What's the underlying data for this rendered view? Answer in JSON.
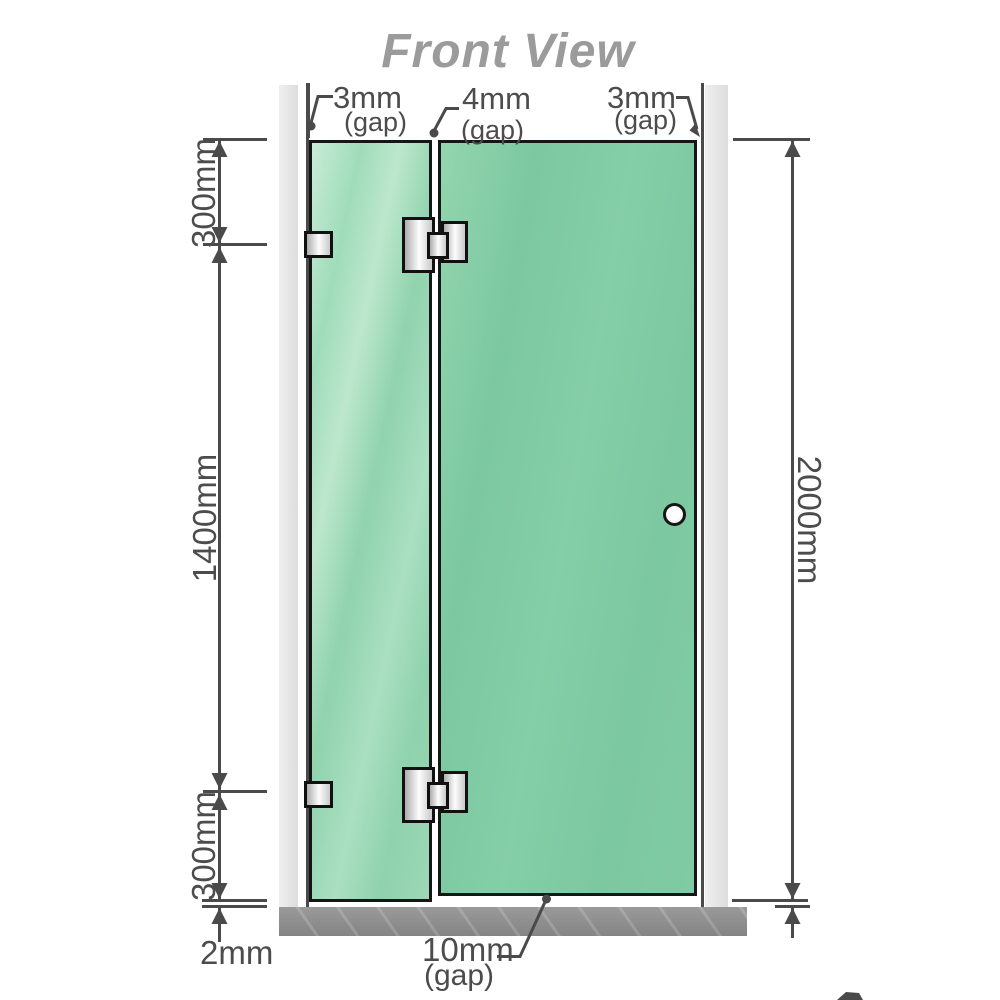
{
  "title": "Front View",
  "diagram": {
    "type": "technical-front-view",
    "subject": "frameless shower screen: fixed glass panel and hinged glass door mounted between two walls over a floor base",
    "top_gap_labels": [
      {
        "value": "3mm",
        "qualifier": "(gap)",
        "position": "left-wall-to-fixed-panel"
      },
      {
        "value": "4mm",
        "qualifier": "(gap)",
        "position": "fixed-panel-to-door"
      },
      {
        "value": "3mm",
        "qualifier": "(gap)",
        "position": "door-to-right-wall"
      }
    ],
    "left_dimensions": [
      {
        "value": "300mm",
        "segment": "top-to-upper-hinge"
      },
      {
        "value": "1400mm",
        "segment": "upper-hinge-to-lower-hinge"
      },
      {
        "value": "300mm",
        "segment": "lower-hinge-to-glass-bottom"
      }
    ],
    "right_dimension": {
      "value": "2000mm",
      "segment": "total-glass-height"
    },
    "bottom_dimensions": {
      "floor_clearance": {
        "value": "2mm",
        "position": "fixed-panel-to-floor"
      },
      "door_floor_gap": {
        "value": "10mm",
        "qualifier": "(gap)",
        "position": "door-bottom-to-floor"
      }
    },
    "hardware": {
      "wall_brackets": 2,
      "glass_hinges": 2,
      "door_knobs": 1
    }
  },
  "colors": {
    "title": "#9b9b9b",
    "line": "#4a4a4a",
    "label": "#4c4c4c",
    "glass_fixed": "#a6dec0",
    "glass_door": "#7dc9a1",
    "wall": "#e4e4e4",
    "floor": "#8d8d8d",
    "watermark_red": "#8c2131"
  }
}
